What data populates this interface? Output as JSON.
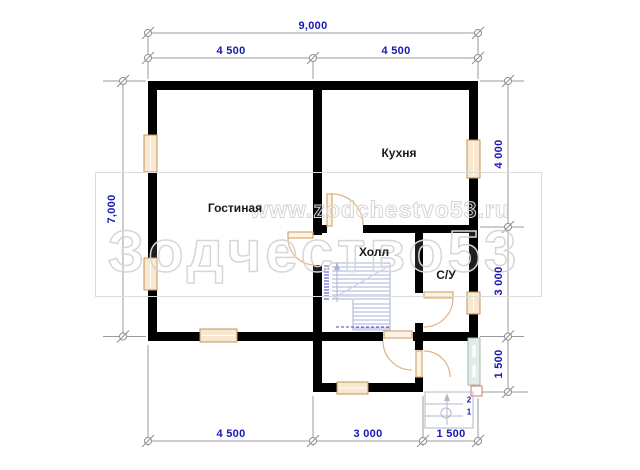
{
  "watermark": {
    "url_text": "www.zodchestvo53.ru",
    "brand_text": "Зодчество53"
  },
  "rooms": [
    {
      "label": "Гостиная"
    },
    {
      "label": "Кухня"
    },
    {
      "label": "Холл"
    },
    {
      "label": "С/У"
    }
  ],
  "dimensions": {
    "top_total": "9,000",
    "top_seg1": "4 500",
    "top_seg2": "4 500",
    "left_total": "7,000",
    "right_seg1": "4 000",
    "right_seg2": "3 000",
    "right_seg3": "1 500",
    "bottom_seg1": "4 500",
    "bottom_seg2": "3 000",
    "bottom_seg3": "1 500"
  },
  "entrance_steps": {
    "step2_label": "2",
    "step1_label": "1"
  },
  "colors": {
    "wall": "#000000",
    "dimension_text": "#1717b5",
    "dimension_line": "#9b9b9b",
    "window_fill": "#f8e8cf",
    "window_border": "#bf9459",
    "door_arc": "#e2b184",
    "stairs": "#a9b2d9",
    "glazed_panel_fill": "#e4ece7",
    "glazed_panel_border": "#a2bbaf",
    "column_marker": "#d98c7e",
    "watermark_outline": "#d6d6d6"
  }
}
